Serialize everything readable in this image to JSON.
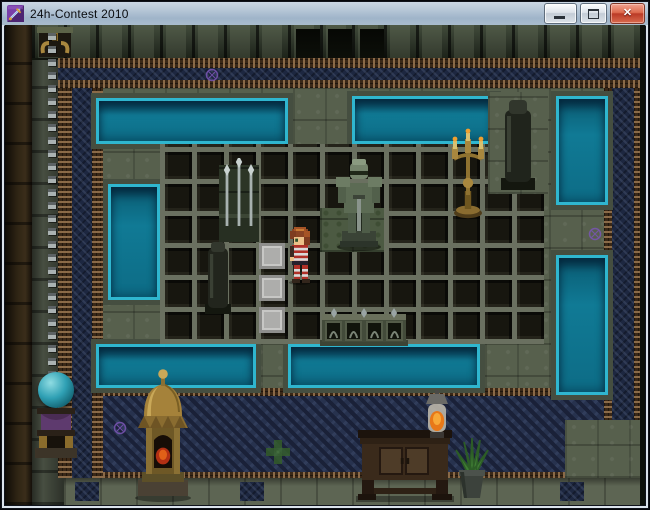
{
  "window": {
    "title": "24h-Contest 2010",
    "app_icon": "sword-app-icon",
    "controls": {
      "minimize_label": "Minimize",
      "maximize_label": "Maximize",
      "close_label": "Close",
      "close_glyph": "✕"
    }
  },
  "scene": {
    "description": "RPG Maker dungeon room: sunken dark tile floor surrounded by stone walkway and teal water pools, mosaic borders, statues and shrine furniture",
    "entities": [
      "hero-sprite",
      "knight-statue",
      "golden-candelabra",
      "large-obelisk",
      "small-obelisk",
      "spear-stand",
      "stone-balustrade",
      "pressure-plate-tiles",
      "hanging-chain",
      "chain-anchor",
      "teal-orb",
      "orb-pedestal",
      "golden-lantern-shrine",
      "wooden-desk",
      "oil-lamp",
      "potted-plant",
      "doorway-alcoves",
      "purple-rune-glyphs",
      "green-cross-mosaic"
    ],
    "palette": {
      "water": "#0e7390",
      "water_edge": "#38c4dc",
      "stone": "#57604d",
      "dark_tile": "#17160f",
      "tile_grout": "#6a7060",
      "mosaic_blue": "#1d2740",
      "floor_mosaic": "#27324e",
      "trim_brown": "#8a6a48",
      "gold": "#a8873e",
      "titlebar_top": "#cbd7e4",
      "titlebar_bottom": "#9fb4c9",
      "close_red": "#bb3a26",
      "rune_purple": "#7a55b5"
    }
  }
}
